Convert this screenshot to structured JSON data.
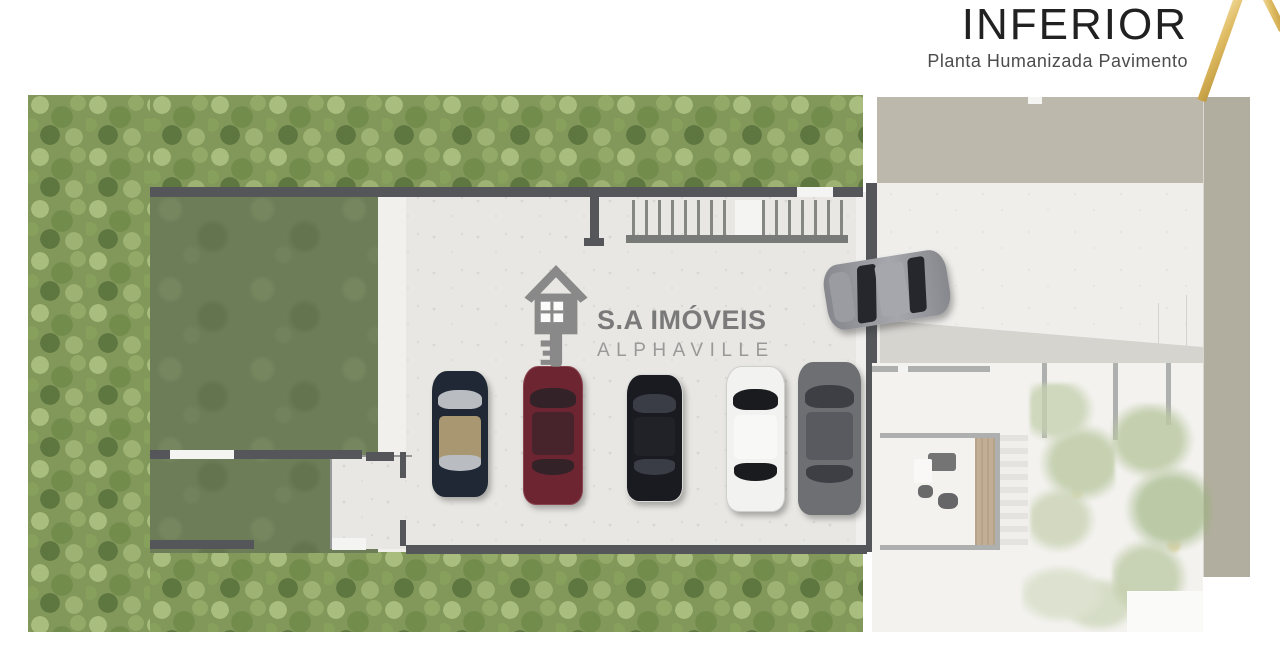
{
  "header": {
    "title": "INFERIOR",
    "subtitle": "Planta Humanizada Pavimento"
  },
  "watermark": {
    "line1": "S.A IMÓVEIS",
    "line2": "ALPHAVILLE"
  },
  "colors": {
    "gold_accent": "#ddb95f",
    "title_text": "#212121",
    "subtitle_text": "#4c4c4c",
    "watermark_gray": "#6c6c6c",
    "wall": "#54565a",
    "lawn_green": "#6d7d58",
    "foliage_green": "#82975a",
    "garage_concrete": "#e8e7e3",
    "driveway": "#efeeeb",
    "terrace_band": "#bdb8ac",
    "side_strip": "#b2ae9f"
  },
  "plan": {
    "parked_cars": [
      {
        "name": "car-convertible-navy",
        "type": "convertible",
        "x": 404,
        "y": 276,
        "w": 56,
        "h": 126,
        "color": "#202836",
        "glass": "#b9bdc2",
        "roof": "#a89770"
      },
      {
        "name": "car-red-sedan",
        "type": "sedan",
        "x": 495,
        "y": 271,
        "w": 58,
        "h": 137,
        "color": "#6d2531",
        "glass": "#332227",
        "roof": "#47242c",
        "trim": "#8a4450"
      },
      {
        "name": "car-black-sedan",
        "type": "sedan",
        "x": 598,
        "y": 279,
        "w": 55,
        "h": 126,
        "color": "#1a1b20",
        "glass": "#3a3d46",
        "roof": "#212228",
        "trim": "#d9d9d9"
      },
      {
        "name": "car-white-sedan",
        "type": "sedan",
        "x": 698,
        "y": 271,
        "w": 57,
        "h": 144,
        "color": "#f2f2f1",
        "glass": "#1a1b1f",
        "roof": "#f8f8f7",
        "trim": "#cfcfcd"
      },
      {
        "name": "car-silver-sports",
        "type": "sports",
        "x": 770,
        "y": 267,
        "w": 63,
        "h": 153,
        "color": "#6e6f73",
        "glass": "#3e3f45",
        "roof": "#595a60"
      }
    ],
    "entering_car": {
      "name": "car-entering-gray",
      "x": 797,
      "y": 162,
      "w": 124,
      "h": 66,
      "rotation": -9,
      "color": "#87888d",
      "glass": "#26272d",
      "roof": "#a6a7ac",
      "hood": "#9b9ca1"
    }
  }
}
